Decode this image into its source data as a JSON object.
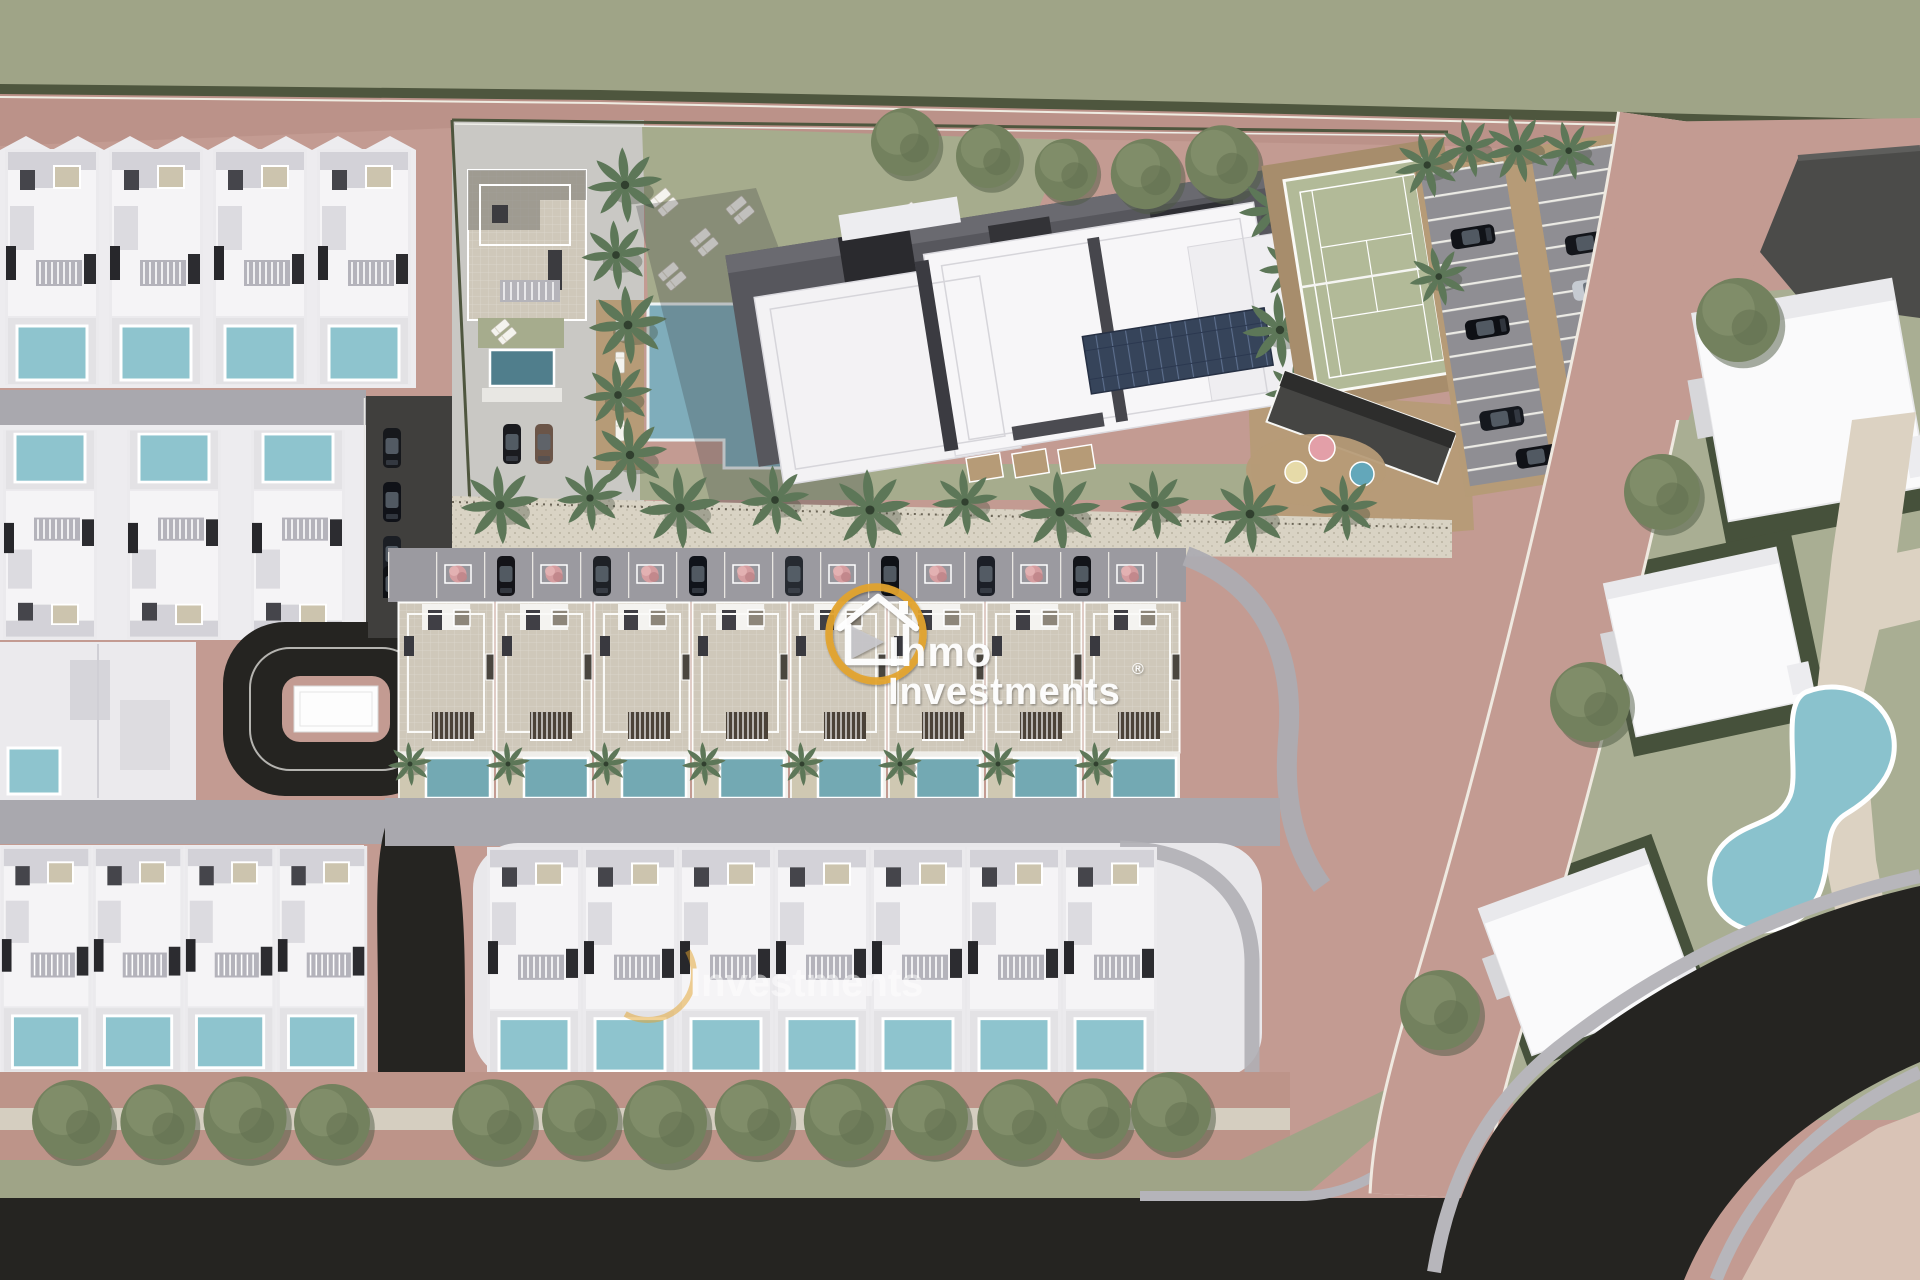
{
  "scene": {
    "description": "Top-down 3D architectural site-plan render of a residential development with villas, townhouses, apartment block, tennis court, pools and roads",
    "development": {
      "townhouse_row_units": 8,
      "front_villa_row_units": 7,
      "left_villa_rows": [
        4,
        3,
        2,
        4
      ],
      "apartment_buildings": 1,
      "tennis_courts": 1,
      "communal_pools": 1,
      "private_pools": 28,
      "parking_bays_in_lot": 26,
      "street_parking_cars": 7,
      "cars_total": 20,
      "playground_items": 3,
      "promenade_palms": 10,
      "street_trees_bottom_row": 13
    },
    "neighbourhood": {
      "detached_houses": 3,
      "kidney_pools": 1
    }
  },
  "watermark": {
    "brand_line1": "Inmo",
    "brand_line2": "Investments",
    "registered_mark": "®",
    "secondary_text": "Investments"
  },
  "palette": {
    "rose": "#c39b92",
    "road-top": "#ba9187",
    "asphalt": "#252421",
    "street": "#9b9aa0",
    "street-dark": "#403f3d",
    "walk": "#a9a8ae",
    "villa": "#f5f4f6",
    "pool-villa": "#8ec4ce",
    "pool-town": "#73a9b3",
    "pool-communal": "#7fadbb",
    "pool-dark": "#507e8c",
    "pool-kidney": "#8ac2cd",
    "lawn": "#a6ac8d",
    "lawn-n": "#a9ae93",
    "plot-dark": "#46513b",
    "band": "#9fa487",
    "hedge": "#4e563e",
    "tan": "#b69b77",
    "tennis": "#b2ba98",
    "tennis-surround": "#a78d6c",
    "stone": "#cfc8ba",
    "tree": "#73815e",
    "palm": "#5d7758",
    "shrub": "#d59da0",
    "cream": "#dcd2c2",
    "promenade": "#d9d3c4",
    "gold": "#e4a42c"
  }
}
